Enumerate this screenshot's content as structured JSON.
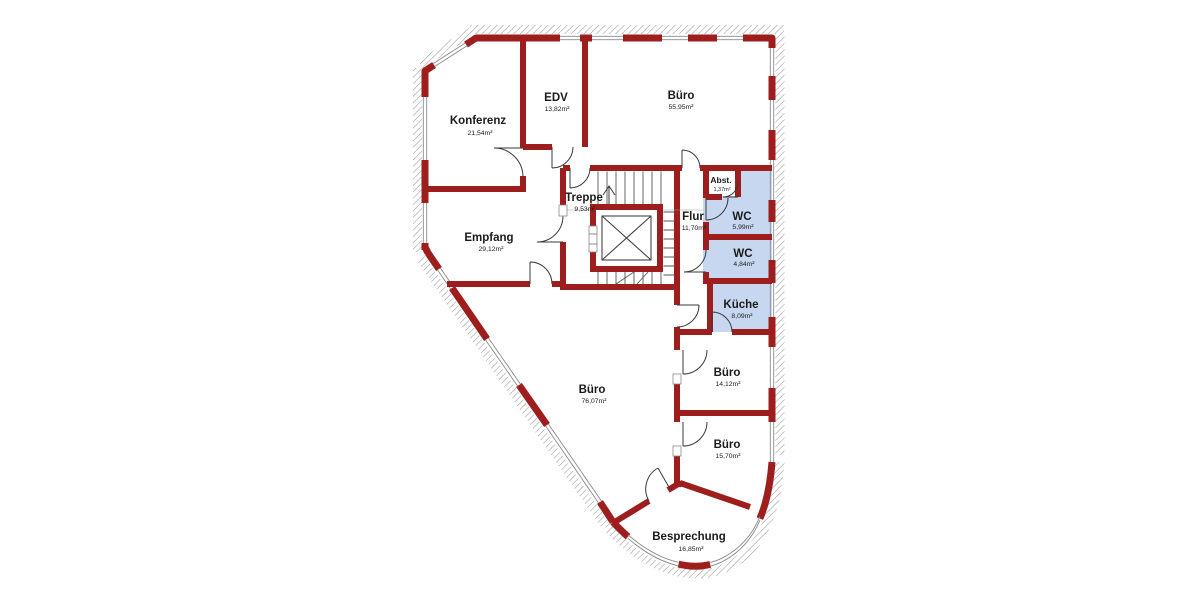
{
  "plan": {
    "colors": {
      "wall": "#9e1e1e",
      "room": "#c7d7f0",
      "line": "#4a4a4a",
      "hatch": "#9a9a9a",
      "text": "#1b1b1b",
      "bg": "#ffffff"
    },
    "legend": {
      "highlight_meaning": "sanitary-rooms-highlighted"
    },
    "rooms": [
      {
        "id": "konferenz",
        "name": "Konferenz",
        "area": "21,54m²"
      },
      {
        "id": "edv",
        "name": "EDV",
        "area": "13,82m²"
      },
      {
        "id": "buero-nord",
        "name": "Büro",
        "area": "55,95m²"
      },
      {
        "id": "treppe",
        "name": "Treppe",
        "area": "9,53m²"
      },
      {
        "id": "flur",
        "name": "Flur",
        "area": "11,70m²"
      },
      {
        "id": "abstellraum",
        "name": "Abst.",
        "area": "1,37m²"
      },
      {
        "id": "wc-1",
        "name": "WC",
        "area": "5,99m²"
      },
      {
        "id": "wc-2",
        "name": "WC",
        "area": "4,84m²"
      },
      {
        "id": "kueche",
        "name": "Küche",
        "area": "8,09m²"
      },
      {
        "id": "empfang",
        "name": "Empfang",
        "area": "29,12m²"
      },
      {
        "id": "buero-west",
        "name": "Büro",
        "area": "76,07m²"
      },
      {
        "id": "buero-ost-1",
        "name": "Büro",
        "area": "14,12m²"
      },
      {
        "id": "buero-ost-2",
        "name": "Büro",
        "area": "15,70m²"
      },
      {
        "id": "besprechung",
        "name": "Besprechung",
        "area": "16,85m²"
      }
    ]
  }
}
